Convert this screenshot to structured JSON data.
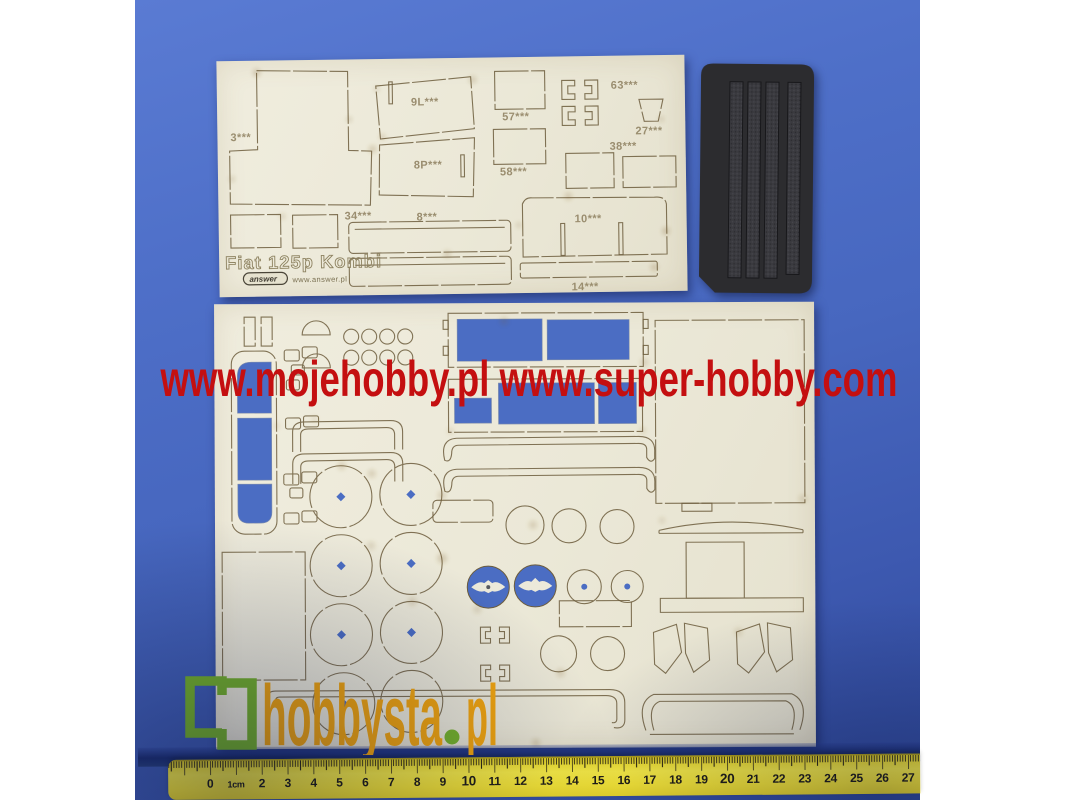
{
  "colors": {
    "background_blue": "#4a68c0",
    "sheet_cream": "#ebe8d8",
    "cutout_blue": "#4b6dc3",
    "watermark_red": "#c40f10",
    "logo_green": "#76b32a",
    "logo_orange": "#f2a50d",
    "ruler_yellow": "#f2e135",
    "rubber_black": "#2d2d30"
  },
  "watermark": {
    "text": "www.mojehobby.pl www.super-hobby.com"
  },
  "sheet1": {
    "title": "Fiat 125p Kombi",
    "brand": "answer",
    "brand_url": "www.answer.pl",
    "parts": {
      "p3": "3***",
      "p9l": "9L***",
      "p8p": "8P***",
      "p57": "57***",
      "p58": "58***",
      "p63": "63***",
      "p27": "27***",
      "p38": "38***",
      "p34": "34***",
      "p8": "8***",
      "p10": "10***",
      "p14": "14***"
    }
  },
  "site_logo": {
    "main": "hobbysta",
    "dot": ".",
    "tld": "pl"
  },
  "ruler": {
    "labels": [
      "0",
      "1cm",
      "2",
      "3",
      "4",
      "5",
      "6",
      "7",
      "8",
      "9",
      "10",
      "11",
      "12",
      "13",
      "14",
      "15",
      "16",
      "17",
      "18",
      "19",
      "20",
      "21",
      "22",
      "23",
      "24",
      "25",
      "26",
      "27",
      "28"
    ]
  }
}
